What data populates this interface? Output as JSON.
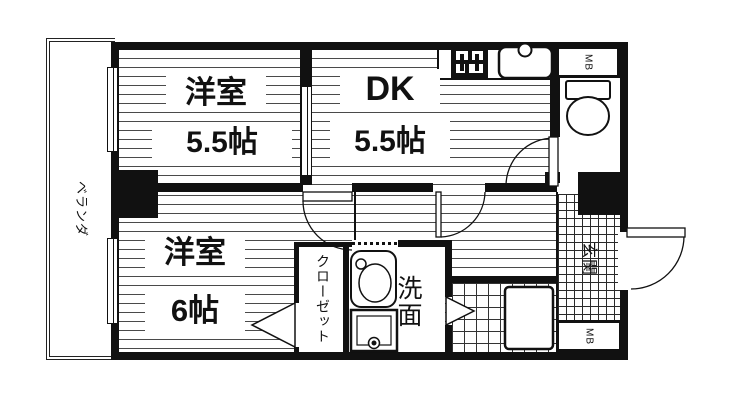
{
  "floorplan": {
    "title": "2DK apartment floor plan",
    "rooms": {
      "western_room_1": {
        "name": "洋室",
        "size": "5.5帖"
      },
      "dining_kitchen": {
        "name": "DK",
        "size": "5.5帖"
      },
      "western_room_2": {
        "name": "洋室",
        "size": "6帖"
      },
      "closet": {
        "name": "クローゼット"
      },
      "washroom": {
        "name": "洗面"
      },
      "entrance": {
        "name": "玄関"
      },
      "veranda": {
        "name": "ベランダ"
      },
      "meter_box_top": {
        "label": "MB"
      },
      "meter_box_bottom": {
        "label": "MB"
      }
    },
    "fixtures": [
      "gas-stove",
      "kitchen-sink",
      "toilet",
      "vanity-sink",
      "washing-machine-pan",
      "bathtub"
    ],
    "colors": {
      "wall": "#111111",
      "floor_line": "#4a4a4a",
      "background": "#ffffff"
    }
  }
}
